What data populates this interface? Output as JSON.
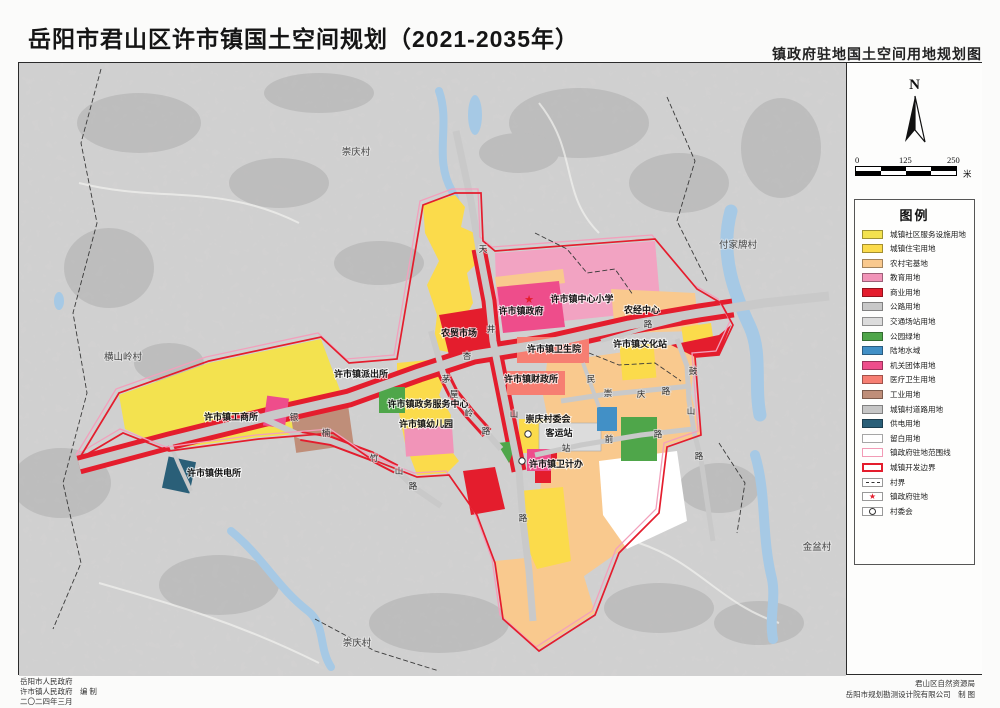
{
  "page": {
    "title": "岳阳市君山区许市镇国土空间规划（2021-2035年）",
    "subtitle": "镇政府驻地国土空间用地规划图"
  },
  "compass": {
    "label": "N"
  },
  "scalebar": {
    "ticks": [
      "0",
      "125",
      "250"
    ],
    "unit": "米"
  },
  "legend": {
    "title": "图例",
    "items": [
      {
        "label": "城镇社区服务设施用地",
        "swatch": "fill",
        "color": "#f3e24f"
      },
      {
        "label": "城镇住宅用地",
        "swatch": "fill",
        "color": "#fbdb4b"
      },
      {
        "label": "农村宅基地",
        "swatch": "fill",
        "color": "#f9c98e"
      },
      {
        "label": "教育用地",
        "swatch": "fill",
        "color": "#f194b8"
      },
      {
        "label": "商业用地",
        "swatch": "fill",
        "color": "#e41d2d"
      },
      {
        "label": "公路用地",
        "swatch": "fill",
        "color": "#c8c8c8"
      },
      {
        "label": "交通场站用地",
        "swatch": "fill",
        "color": "#dcdcdc"
      },
      {
        "label": "公园绿地",
        "swatch": "fill",
        "color": "#4fa64a"
      },
      {
        "label": "陆地水域",
        "swatch": "fill",
        "color": "#4290c6"
      },
      {
        "label": "机关团体用地",
        "swatch": "fill",
        "color": "#ee4d8b"
      },
      {
        "label": "医疗卫生用地",
        "swatch": "fill",
        "color": "#f67e72"
      },
      {
        "label": "工业用地",
        "swatch": "fill",
        "color": "#bf8e79"
      },
      {
        "label": "城镇村道路用地",
        "swatch": "fill",
        "color": "#c6c6c6"
      },
      {
        "label": "供电用地",
        "swatch": "fill",
        "color": "#2a5f78"
      },
      {
        "label": "留白用地",
        "swatch": "fill",
        "color": "#ffffff"
      },
      {
        "label": "镇政府驻地范围线",
        "swatch": "outline",
        "color": "#f29bb6"
      },
      {
        "label": "城镇开发边界",
        "swatch": "outline-thick",
        "color": "#e41d2d"
      },
      {
        "label": "村界",
        "swatch": "dash",
        "color": "#333333"
      },
      {
        "label": "镇政府驻地",
        "swatch": "star",
        "color": "#e41d2d"
      },
      {
        "label": "村委会",
        "swatch": "circle",
        "color": "#333333"
      }
    ]
  },
  "map": {
    "villages": [
      {
        "label": "崇庆村",
        "x": 337,
        "y": 92
      },
      {
        "label": "付家牌村",
        "x": 719,
        "y": 185
      },
      {
        "label": "横山岭村",
        "x": 104,
        "y": 297
      },
      {
        "label": "金盆村",
        "x": 798,
        "y": 487
      },
      {
        "label": "崇庆村",
        "x": 338,
        "y": 583
      }
    ],
    "facilities": [
      {
        "label": "许市镇政府",
        "x": 502,
        "y": 251
      },
      {
        "label": "许市镇中心小学",
        "x": 563,
        "y": 239
      },
      {
        "label": "农经中心",
        "x": 623,
        "y": 250
      },
      {
        "label": "农贸市场",
        "x": 440,
        "y": 273
      },
      {
        "label": "许市镇卫生院",
        "x": 535,
        "y": 289
      },
      {
        "label": "许市镇文化站",
        "x": 621,
        "y": 284
      },
      {
        "label": "许市镇派出所",
        "x": 342,
        "y": 314
      },
      {
        "label": "许市镇财政所",
        "x": 512,
        "y": 319
      },
      {
        "label": "许市镇工商所",
        "x": 212,
        "y": 357
      },
      {
        "label": "许市镇政务服务中心",
        "x": 409,
        "y": 344
      },
      {
        "label": "许市镇幼儿园",
        "x": 407,
        "y": 364
      },
      {
        "label": "崇庆村委会",
        "x": 529,
        "y": 359
      },
      {
        "label": "客运站",
        "x": 540,
        "y": 373
      },
      {
        "label": "许市镇供电所",
        "x": 195,
        "y": 413
      },
      {
        "label": "许市镇卫计办",
        "x": 537,
        "y": 404
      }
    ],
    "road_chars": [
      {
        "ch": "银",
        "x": 275,
        "y": 357
      },
      {
        "ch": "杏",
        "x": 448,
        "y": 296
      },
      {
        "ch": "楠",
        "x": 307,
        "y": 373
      },
      {
        "ch": "竹",
        "x": 355,
        "y": 398
      },
      {
        "ch": "山",
        "x": 380,
        "y": 411
      },
      {
        "ch": "路",
        "x": 394,
        "y": 426
      },
      {
        "ch": "天",
        "x": 464,
        "y": 189
      },
      {
        "ch": "井",
        "x": 472,
        "y": 269
      },
      {
        "ch": "山",
        "x": 495,
        "y": 354
      },
      {
        "ch": "路",
        "x": 504,
        "y": 458
      },
      {
        "ch": "茅",
        "x": 427,
        "y": 319
      },
      {
        "ch": "屋",
        "x": 435,
        "y": 334
      },
      {
        "ch": "岭",
        "x": 450,
        "y": 353
      },
      {
        "ch": "路",
        "x": 467,
        "y": 371
      },
      {
        "ch": "鼓",
        "x": 674,
        "y": 311
      },
      {
        "ch": "山",
        "x": 672,
        "y": 351
      },
      {
        "ch": "路",
        "x": 680,
        "y": 396
      },
      {
        "ch": "崇",
        "x": 589,
        "y": 333
      },
      {
        "ch": "庆",
        "x": 622,
        "y": 334
      },
      {
        "ch": "路",
        "x": 647,
        "y": 331
      },
      {
        "ch": "站",
        "x": 547,
        "y": 388
      },
      {
        "ch": "前",
        "x": 590,
        "y": 379
      },
      {
        "ch": "路",
        "x": 639,
        "y": 374
      },
      {
        "ch": "民",
        "x": 572,
        "y": 319
      },
      {
        "ch": "路",
        "x": 629,
        "y": 264
      }
    ],
    "symbols": {
      "town_seat_star": {
        "x": 510,
        "y": 240
      },
      "village_committees": [
        {
          "x": 509,
          "y": 371
        },
        {
          "x": 503,
          "y": 398
        }
      ]
    }
  },
  "credits": {
    "left": [
      "岳阳市人民政府",
      "许市镇人民政府　编 制",
      "二〇二四年三月"
    ],
    "right": [
      "君山区自然资源局",
      "岳阳市规划勘测设计院有限公司　制 图"
    ]
  }
}
